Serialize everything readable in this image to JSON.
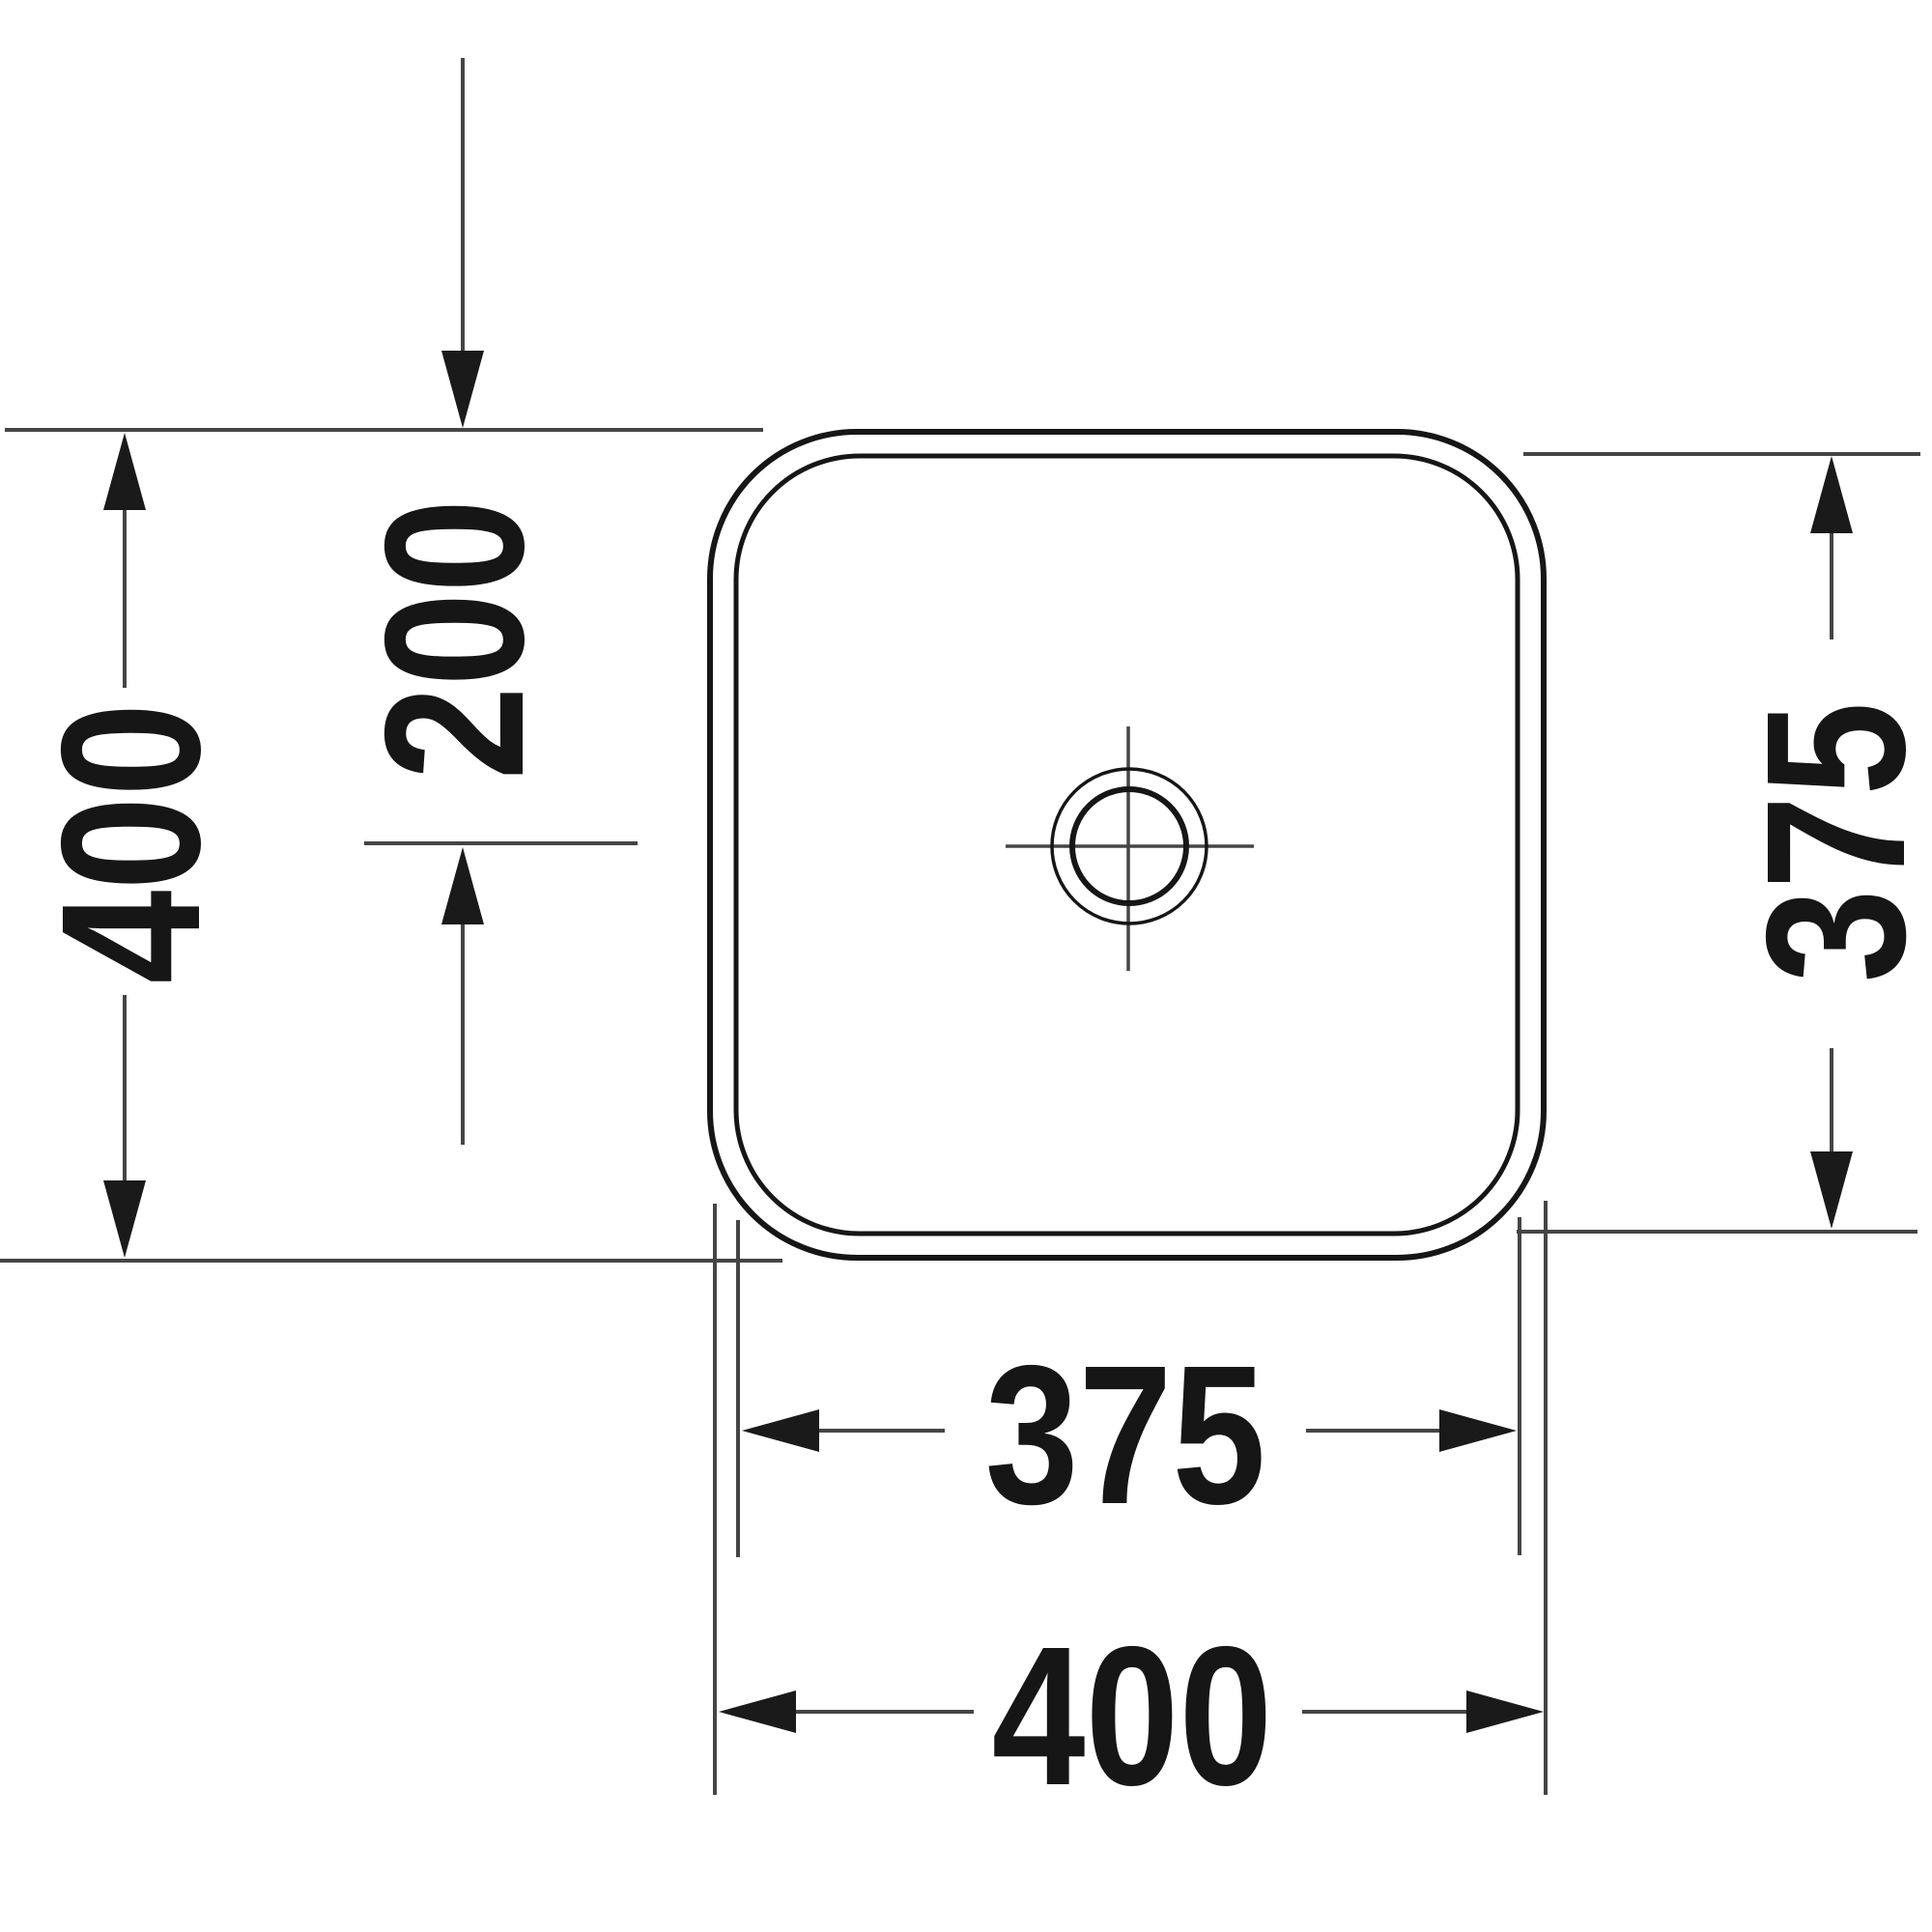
{
  "drawing": {
    "type": "technical-dimension-drawing",
    "subject": "square-basin-top-view",
    "unit": "mm",
    "colors": {
      "background": "#ffffff",
      "outline": "#161616",
      "dimension_line": "#454545",
      "arrowhead": "#1a1a1a",
      "text": "#161616"
    },
    "dimensions": {
      "outer_height": "400",
      "drain_center_from_top": "200",
      "inner_height": "375",
      "inner_width": "375",
      "outer_width": "400"
    }
  }
}
